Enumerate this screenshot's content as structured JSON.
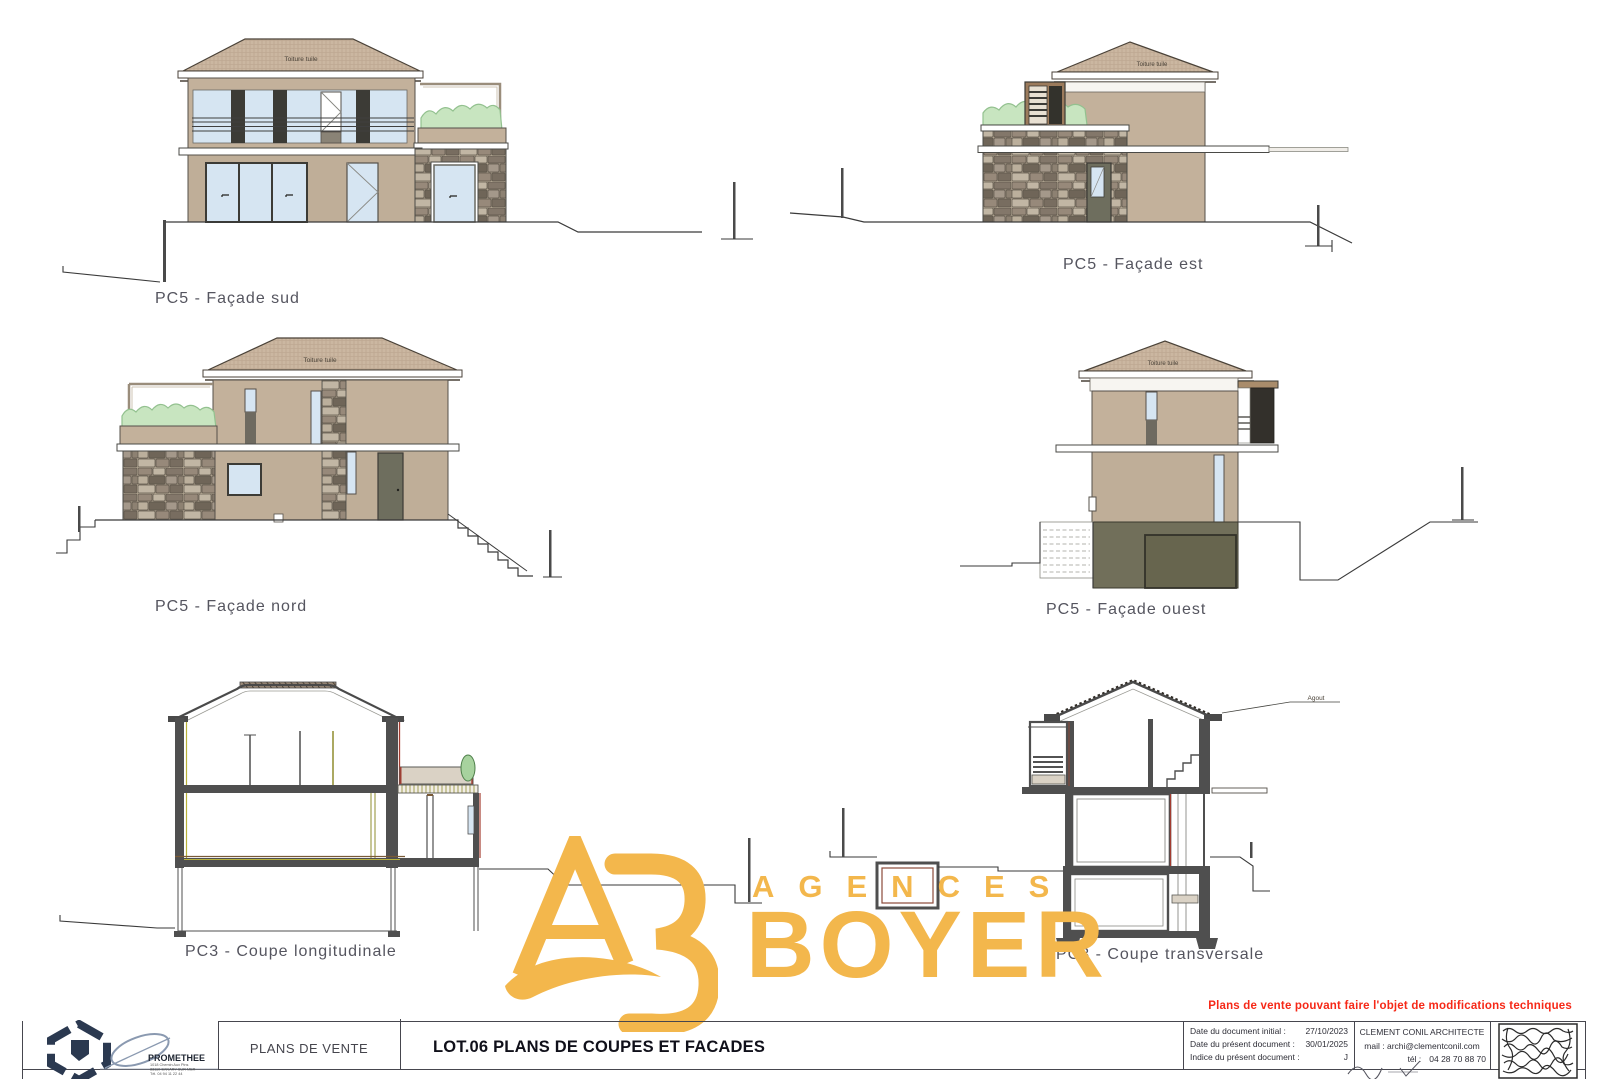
{
  "drawings": {
    "facade_sud": {
      "label": "PC5 - Façade sud",
      "roof_label": "Toiture tuile"
    },
    "facade_est": {
      "label": "PC5 - Façade est",
      "roof_label": "Toiture tuile"
    },
    "facade_nord": {
      "label": "PC5 - Façade nord",
      "roof_label": "Toiture tuile"
    },
    "facade_ouest": {
      "label": "PC5 - Façade ouest",
      "roof_label": "Toiture tuile"
    },
    "coupe_longitudinale": {
      "label": "PC3 - Coupe longitudinale"
    },
    "coupe_transversale": {
      "label": "PC3 - Coupe transversale",
      "annotation": "Agout"
    }
  },
  "watermark": {
    "word_top": "AGENCES",
    "word_bottom": "BOYER",
    "color": "#F3B74C"
  },
  "notice": "Plans de vente pouvant faire l'objet de modifications techniques",
  "title_block": {
    "doc_type": "PLANS DE VENTE",
    "sheet_title": "LOT.06 PLANS DE COUPES ET FACADES",
    "promethee": {
      "name": "PROMETHEE",
      "address_line1": "1018 Chemin Aux Pins",
      "address_line2": "83110 SANARY SUR MER",
      "address_line3": "Tél. 04 94 11 22 44"
    },
    "dates": {
      "row1_label": "Date du document initial :",
      "row1_value": "27/10/2023",
      "row2_label": "Date du présent document :",
      "row2_value": "30/01/2025",
      "row3_label": "Indice du présent document :",
      "row3_value": "J"
    },
    "architect": {
      "name": "CLEMENT CONIL ARCHITECTE",
      "mail_label": "mail :",
      "mail_value": "archi@clementconil.com",
      "tel_label": "tél :",
      "tel_value": "04 28 70 88 70"
    }
  },
  "palette": {
    "wall_tan": "#C3B19B",
    "glass_blue": "#D6E5F2",
    "basement_olive": "#716F5A",
    "section_grey": "#4f4f4f",
    "watermark_gold": "#F3B74C",
    "notice_red": "#F62817"
  }
}
